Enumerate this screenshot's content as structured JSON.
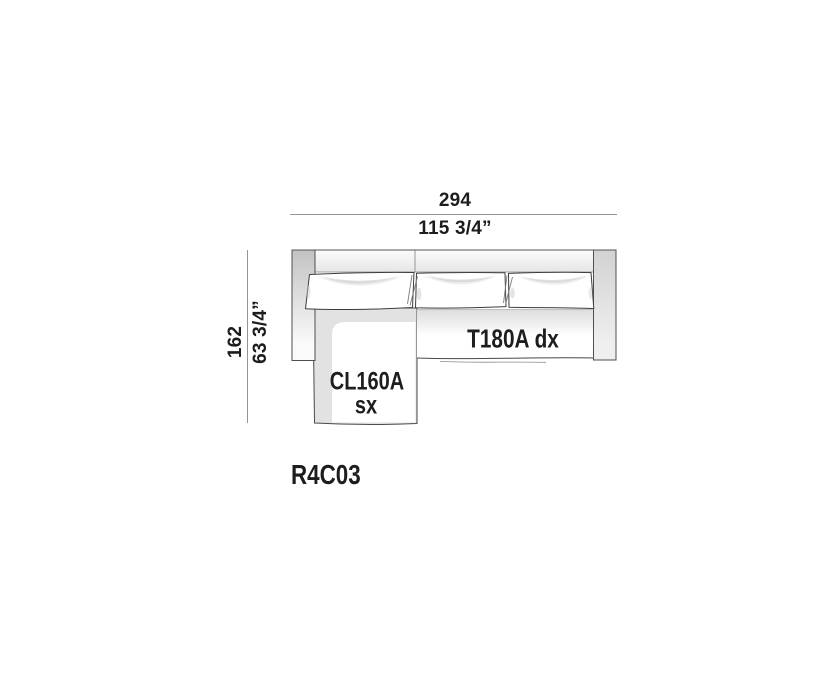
{
  "diagram": {
    "model_code": "R4C03",
    "width": {
      "cm": "294",
      "inches": "115 3/4”"
    },
    "depth": {
      "cm": "162",
      "inches": "63 3/4”"
    },
    "modules": {
      "chaise": {
        "code": "CL160A",
        "side": "sx"
      },
      "end_sofa": {
        "label": "T180A dx"
      }
    }
  },
  "colors": {
    "ink": "#1d1d1b",
    "dimension_line": "#949494",
    "outline": "#4a4a4a",
    "background": "#ffffff"
  }
}
